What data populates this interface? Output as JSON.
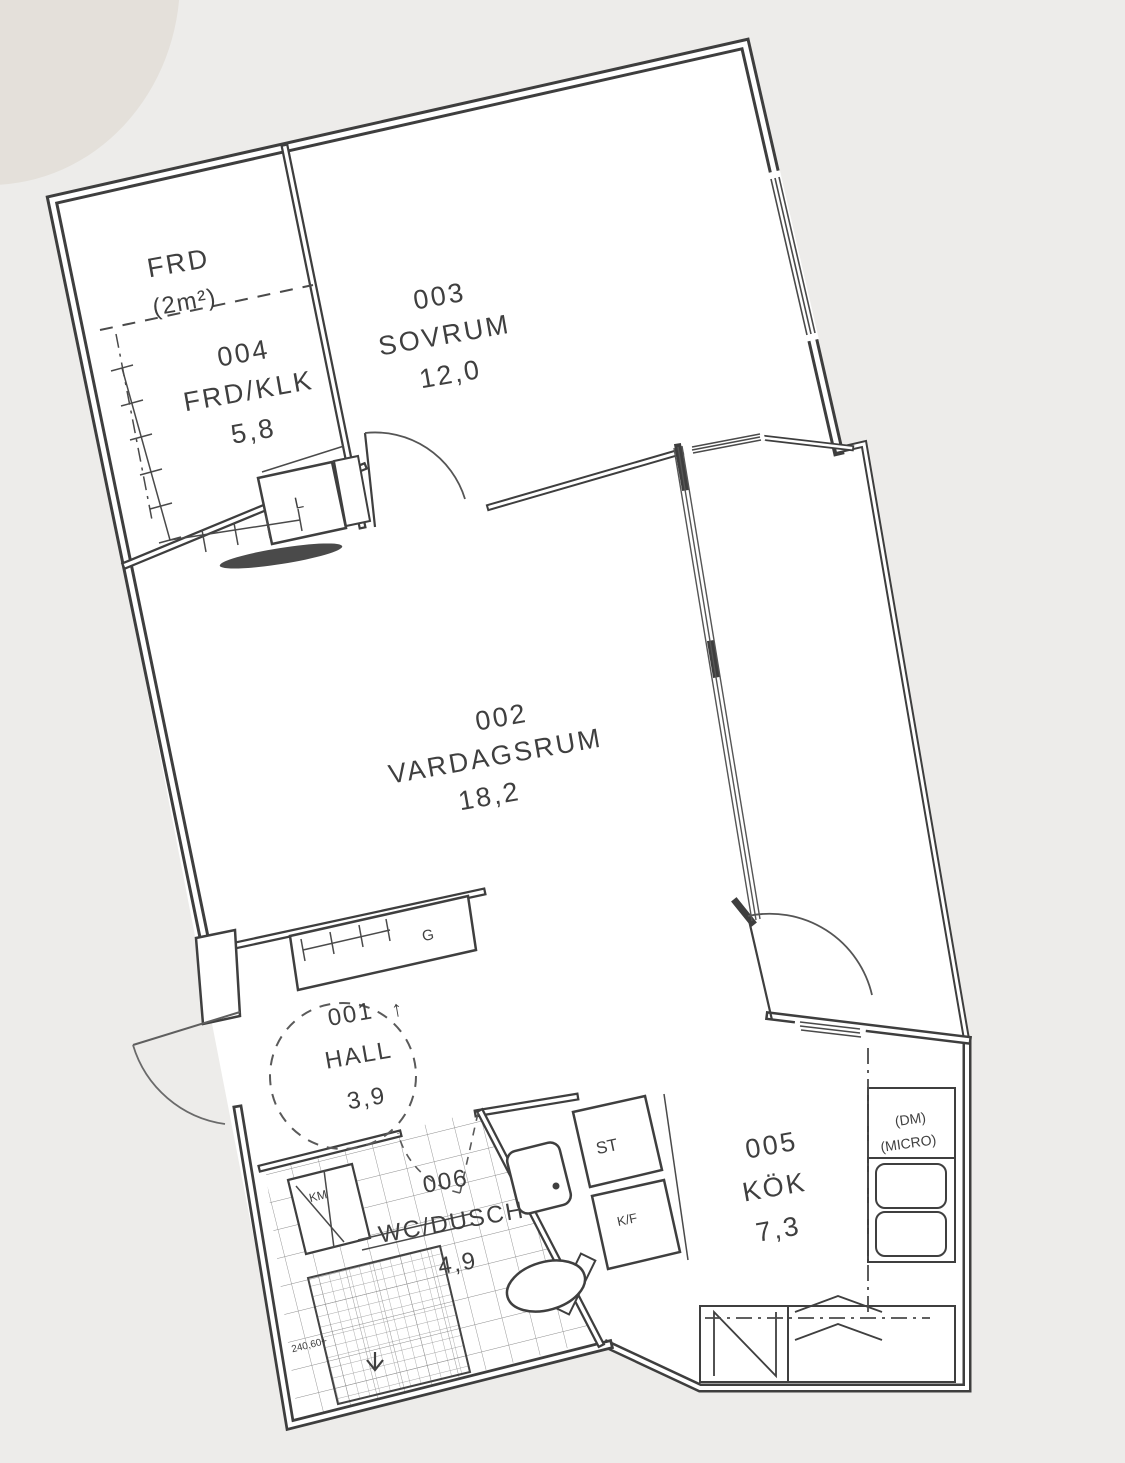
{
  "plan_title": "Apartment floor plan",
  "colors": {
    "background": "#edecea",
    "floor": "#ffffff",
    "line": "#3e3e3e",
    "text": "#3f3f3f",
    "pocket_door": "#4a4a4a"
  },
  "rooms": [
    {
      "number": "001",
      "name": "HALL",
      "area": "3,9",
      "entry_marker": "↑"
    },
    {
      "number": "002",
      "name": "VARDAGSRUM",
      "area": "18,2"
    },
    {
      "number": "003",
      "name": "SOVRUM",
      "area": "12,0"
    },
    {
      "number": "004",
      "name": "FRD/KLK",
      "area": "5,8"
    },
    {
      "number": "005",
      "name": "KÖK",
      "area": "7,3"
    },
    {
      "number": "006",
      "name": "WC/DUSCH",
      "area": "4,9"
    }
  ],
  "annotations": {
    "storage_label": "FRD",
    "storage_area": "(2m²)",
    "linen_closet": "L",
    "wardrobe": "G",
    "washing_machine": "KM",
    "cleaning_closet": "ST",
    "fridge_freezer": "K/F",
    "dishwasher": "(DM)",
    "microwave": "(MICRO)",
    "shower_dimension": "240,60+"
  }
}
